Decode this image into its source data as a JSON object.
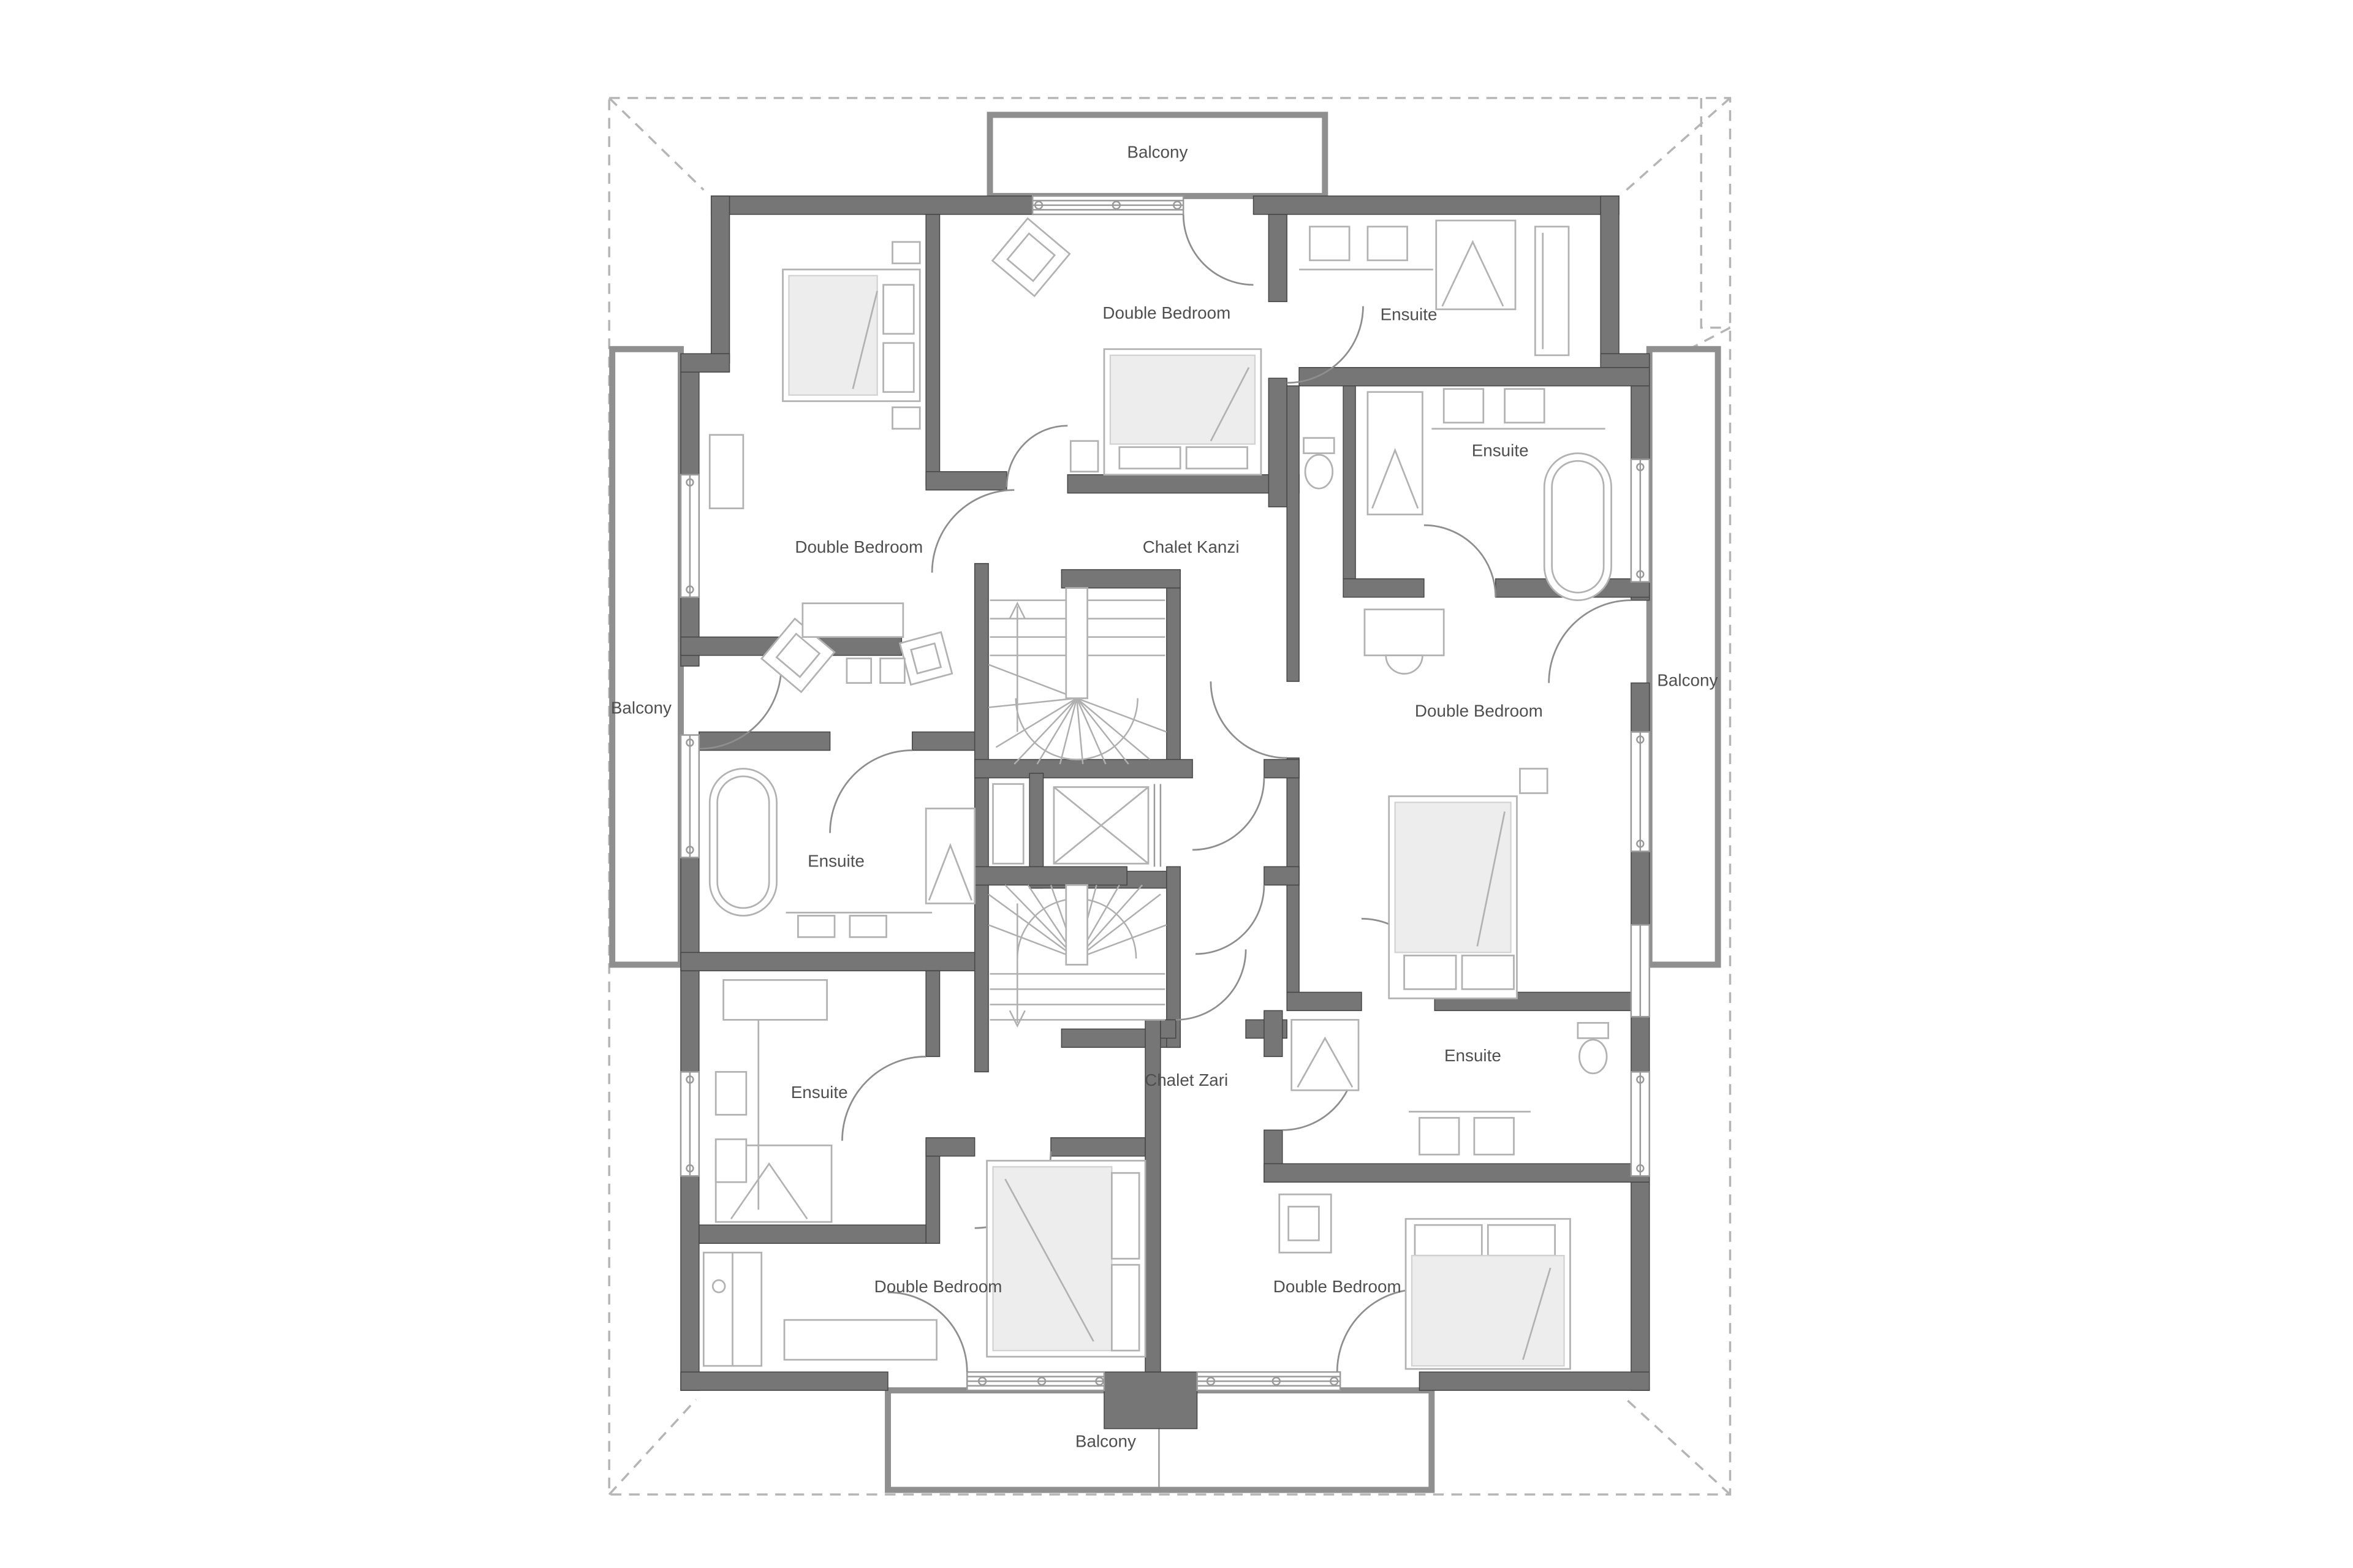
{
  "plan": {
    "type": "architectural-floor-plan",
    "units": [
      {
        "name": "Chalet Kanzi"
      },
      {
        "name": "Chalet Zari"
      }
    ],
    "rooms": [
      {
        "id": "balcony-top",
        "label": "Balcony"
      },
      {
        "id": "double-bedroom-top",
        "label": "Double Bedroom"
      },
      {
        "id": "ensuite-top-right",
        "label": "Ensuite"
      },
      {
        "id": "ensuite-right",
        "label": "Ensuite"
      },
      {
        "id": "double-bedroom-left",
        "label": "Double Bedroom"
      },
      {
        "id": "chalet-kanzi",
        "label": "Chalet Kanzi"
      },
      {
        "id": "balcony-left",
        "label": "Balcony"
      },
      {
        "id": "balcony-right",
        "label": "Balcony"
      },
      {
        "id": "double-bedroom-right",
        "label": "Double Bedroom"
      },
      {
        "id": "ensuite-left",
        "label": "Ensuite"
      },
      {
        "id": "ensuite-bottom-left",
        "label": "Ensuite"
      },
      {
        "id": "chalet-zari",
        "label": "Chalet Zari"
      },
      {
        "id": "ensuite-bottom-right",
        "label": "Ensuite"
      },
      {
        "id": "double-bedroom-bottom-left",
        "label": "Double Bedroom"
      },
      {
        "id": "double-bedroom-bottom-right",
        "label": "Double Bedroom"
      },
      {
        "id": "balcony-bottom",
        "label": "Balcony"
      }
    ],
    "symbols": [
      "staircase-icon",
      "elevator-icon",
      "bed-icon",
      "bathtub-icon",
      "shower-icon",
      "sink-vanity-icon",
      "toilet-icon",
      "door-swing-icon",
      "window-icon",
      "wardrobe-icon",
      "chair-icon",
      "desk-icon"
    ],
    "colors": {
      "wall": "#767676",
      "balcony_outline": "#8f8f8f",
      "roof_dashed": "#b5b5b5",
      "furniture": "#b2b2b2",
      "mattress": "#ededed",
      "label_text": "#4f4f4f",
      "background": "#ffffff"
    }
  }
}
